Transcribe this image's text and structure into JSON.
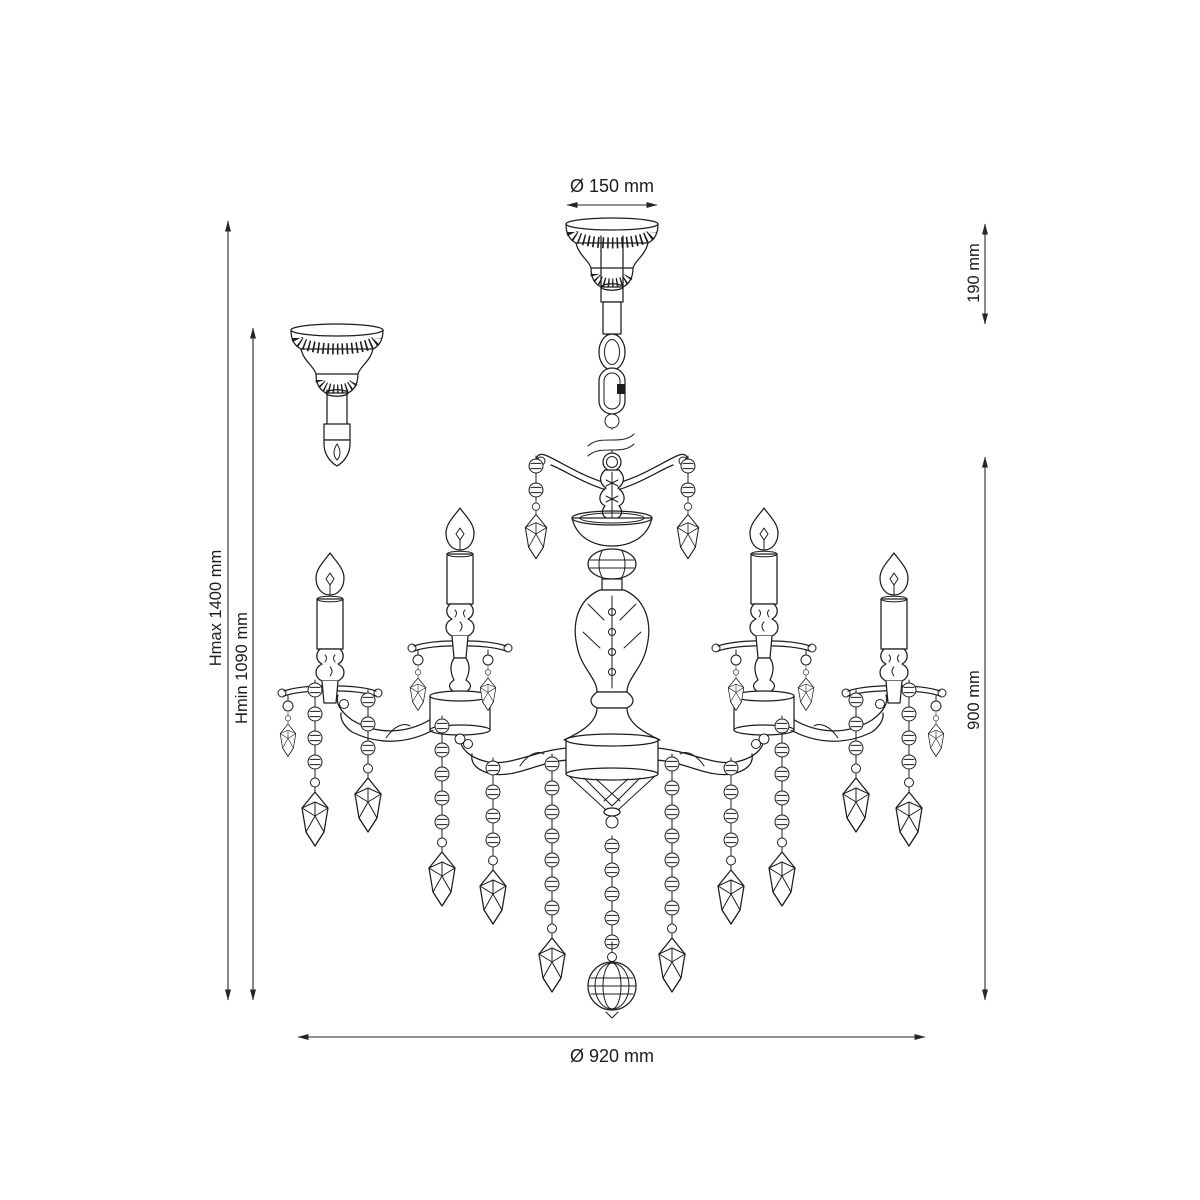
{
  "drawing": {
    "subject": "chandelier",
    "style": "technical line drawing with dimensions"
  },
  "colors": {
    "line": "#1d1d1b",
    "dimension": "#262626",
    "background": "#ffffff"
  },
  "labels": {
    "top_diameter": "Ø 150 mm",
    "hang_height": "190 mm",
    "body_height": "900 mm",
    "hmax": "Hmax 1400 mm",
    "hmin": "Hmin 1090 mm",
    "body_diameter": "Ø 920 mm"
  }
}
